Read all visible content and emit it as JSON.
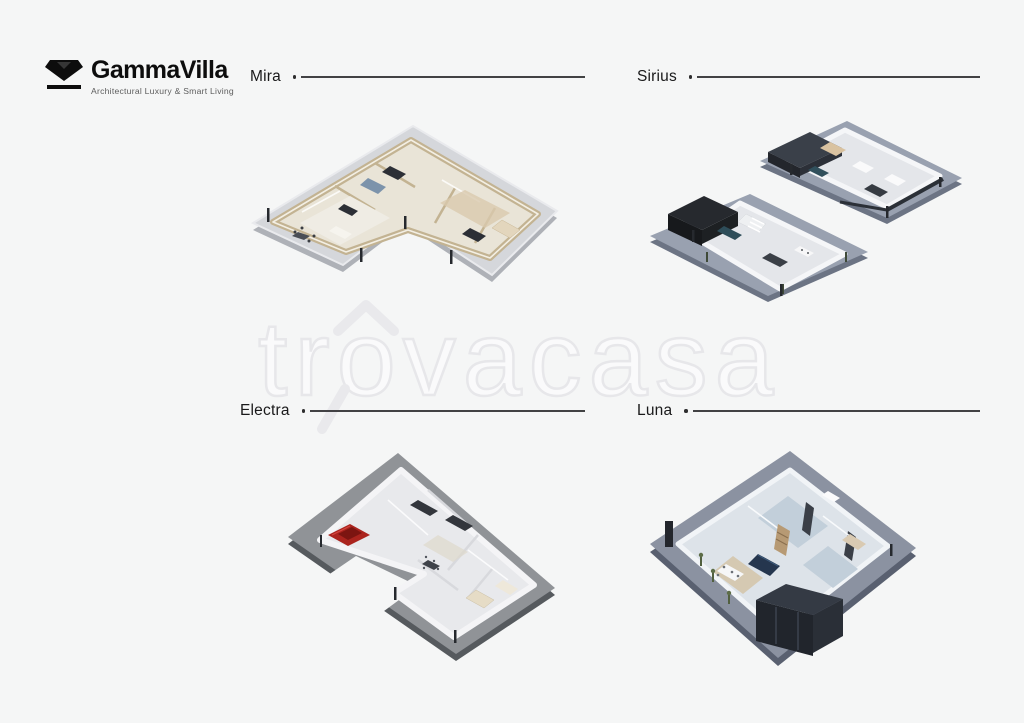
{
  "page": {
    "background": "#f5f6f6"
  },
  "brand": {
    "name": "GammaVilla",
    "tagline": "Architectural Luxury & Smart Living",
    "icon": "diamond-gem-icon",
    "color": "#0d0d0d"
  },
  "watermark": {
    "text": "trovacasa",
    "icon": "magnifier-house-icon",
    "fill": "#fafafb",
    "outline": "#e7e7ea"
  },
  "plans": [
    {
      "label": "Mira",
      "illustration": "isometric-floorplan-l-shaped-single-storey",
      "platform_color": "#d5d7db",
      "wall_color": "#c3b392"
    },
    {
      "label": "Sirius",
      "illustration": "isometric-floorplans-two-storeys",
      "platform_color": "#99a1b0",
      "wall_color": "#f5f6f8"
    },
    {
      "label": "Electra",
      "illustration": "isometric-floorplan-garage-with-red-car",
      "platform_color": "#909397",
      "wall_color": "#f4f4f6",
      "car_color": "#ab241e"
    },
    {
      "label": "Luna",
      "illustration": "isometric-floorplan-square-single-storey",
      "platform_color": "#8b92a1",
      "wall_color": "#f1f4f7"
    }
  ],
  "leader_line": {
    "color": "#424244"
  }
}
